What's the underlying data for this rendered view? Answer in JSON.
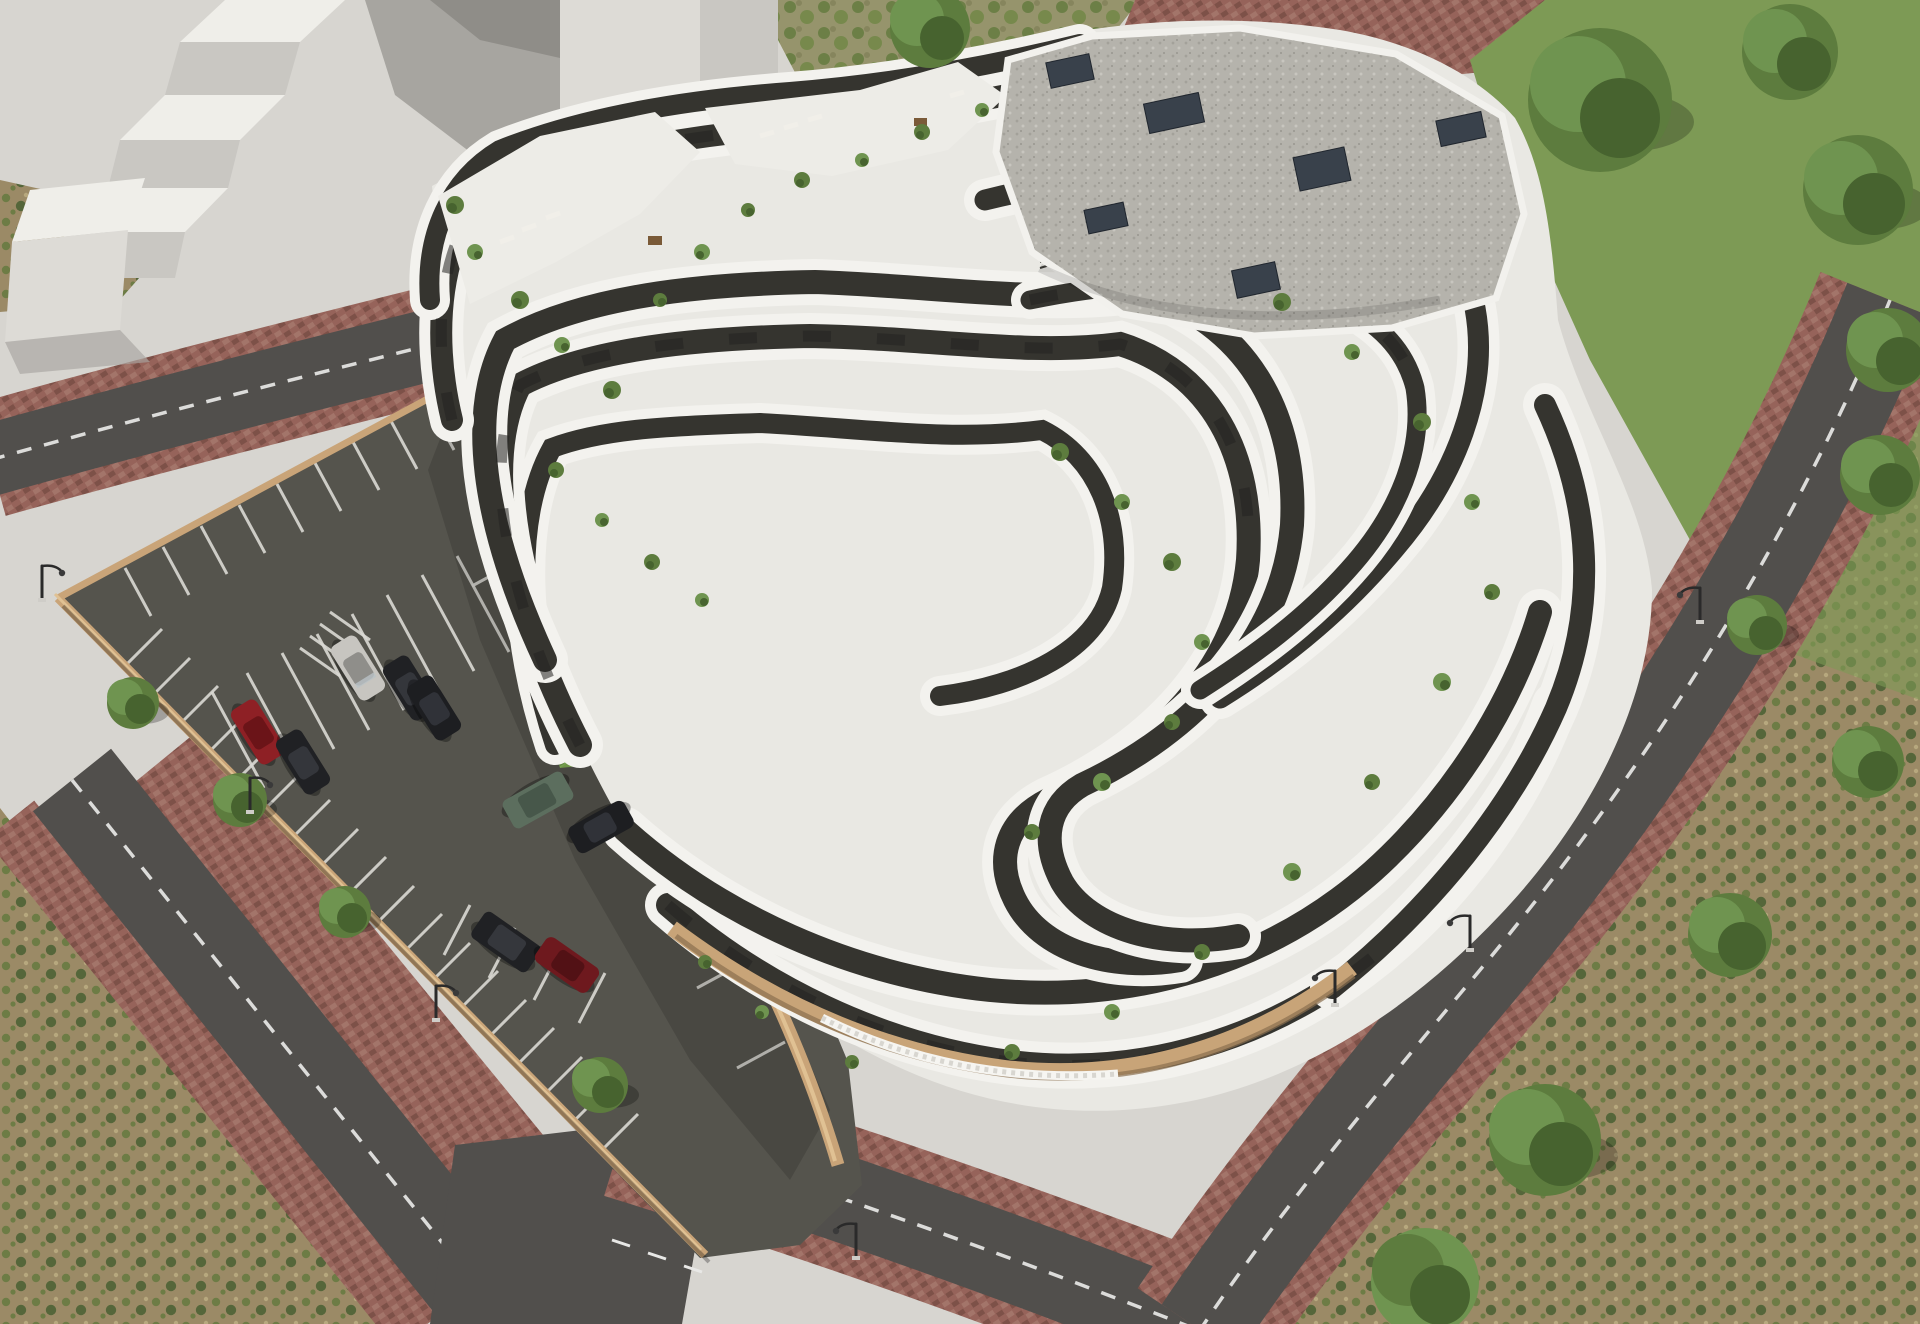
{
  "scene": {
    "alt": "Aerial 3D architectural render of a white terraced apartment complex with wavy balcony bands around a courtyard with lawn, freeform pool, sun loungers, umbrellas and a small playground; open parking lot with cars on the left, ring roads with red paver sidewalks, white context massing blocks at top-left, scrub ground and trees around the edges",
    "view": "aerial-oblique",
    "time_of_day": "day"
  },
  "palette": {
    "plaza": "#d7d5d0",
    "plazaShadow": "#a7a5a0",
    "massTop": "#efeee9",
    "massFace": "#c9c7c2",
    "massFace2": "#dddbd6",
    "grassPatchyBase": "#96946c",
    "grassGreen": "#7d9a55",
    "scrubBase": "#9b8a66",
    "scrubGreen": "#6d7c45",
    "lawn": "#6f9448",
    "asphalt": "#514f4c",
    "parkingAsphalt": "#55544d",
    "roadLine": "#e8e8e6",
    "stallLine": "#dad9d4",
    "paver": "#96635a",
    "paverDark": "#7d5148",
    "wallTan": "#c9a478",
    "wallHi": "#e0c193",
    "bldgBase": "#e9e8e3",
    "bldgWhite": "#f3f2ee",
    "facade": "#35342f",
    "glass": "#232220",
    "terrace": "#edece7",
    "gravel": "#b5b3ac",
    "hvac": "#39414b",
    "podiumTan": "#c8a478",
    "plant1": "#5d7c3e",
    "plant2": "#6f9450",
    "plant3": "#47632f",
    "poolRim": "#f0efe9",
    "poolWater": "#9fd8d8",
    "poolLight": "#c6ebe8",
    "deckWood": "#8b8c84",
    "umbrellaTan": "#d6c29a",
    "woodBrown": "#7a5a38",
    "lampDark": "#2a2a2a",
    "carSilver": "#c7c5c0",
    "carBlack": "#202124",
    "carRed": "#8e2025",
    "carDarkRed": "#6e191e",
    "carGreen": "#5c6e5e"
  },
  "inventory": {
    "context_massing_blocks": 4,
    "roads": 4,
    "street_lamps": 7,
    "trees": 15,
    "parking_cars": 9,
    "pools": 1,
    "playgrounds": 1,
    "tan_umbrellas": 3,
    "white_parasols": 3,
    "roof_hvac_units": 6,
    "building_floor_bands": 11
  },
  "cars": [
    {
      "color_name": "silver"
    },
    {
      "color_name": "black"
    },
    {
      "color_name": "black"
    },
    {
      "color_name": "red"
    },
    {
      "color_name": "black"
    },
    {
      "color_name": "green"
    },
    {
      "color_name": "black"
    },
    {
      "color_name": "black"
    },
    {
      "color_name": "dark-red"
    }
  ]
}
